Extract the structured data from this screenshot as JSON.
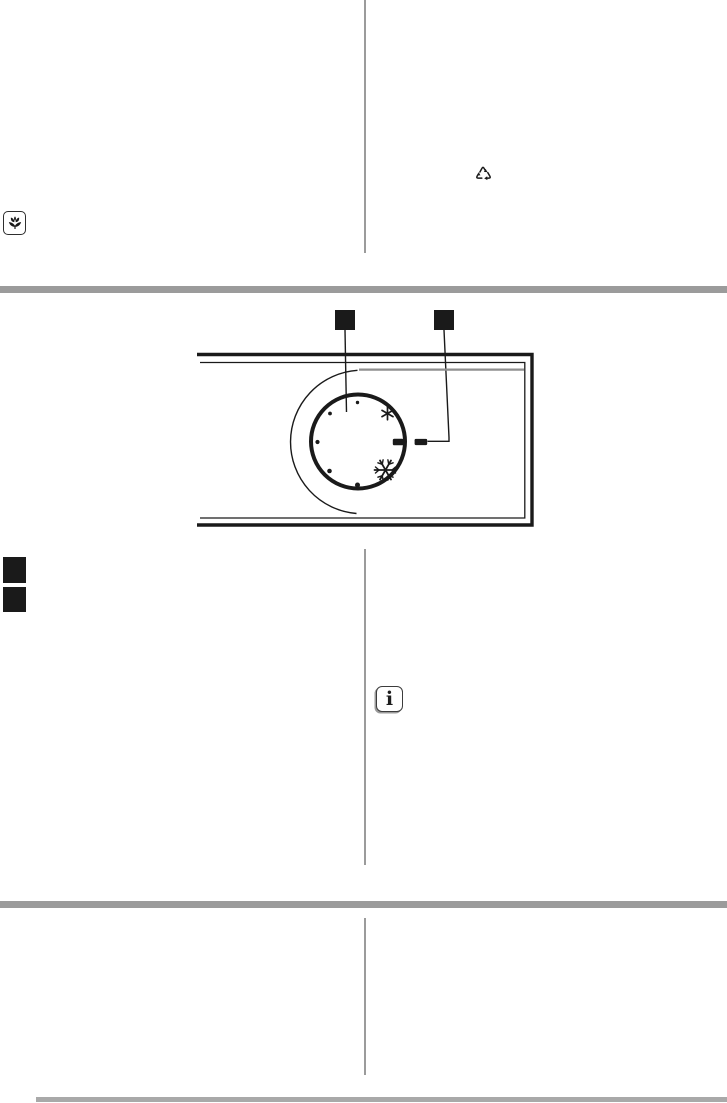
{
  "colors": {
    "page-bg": "#ffffff",
    "divider": "#9b9b9b",
    "footer-rule": "#a9a9a9",
    "ink": "#1a1a1a",
    "groove": "#8f8f8f"
  },
  "icons": {
    "flower": "flower-in-box-symbol",
    "recycling": "recycling-chasing-arrows-symbol",
    "info": "information-i-symbol"
  },
  "info_note": {
    "glyph": "i"
  },
  "figure": {
    "callout_markers": [
      {
        "label": ""
      },
      {
        "label": ""
      }
    ],
    "list_markers": [
      {
        "label": ""
      },
      {
        "label": ""
      }
    ],
    "dial": {
      "setting_dots": 5,
      "symbols": [
        "snowflake-small",
        "snowflake-large",
        "off-dash",
        "panel-alignment-dash"
      ]
    }
  }
}
